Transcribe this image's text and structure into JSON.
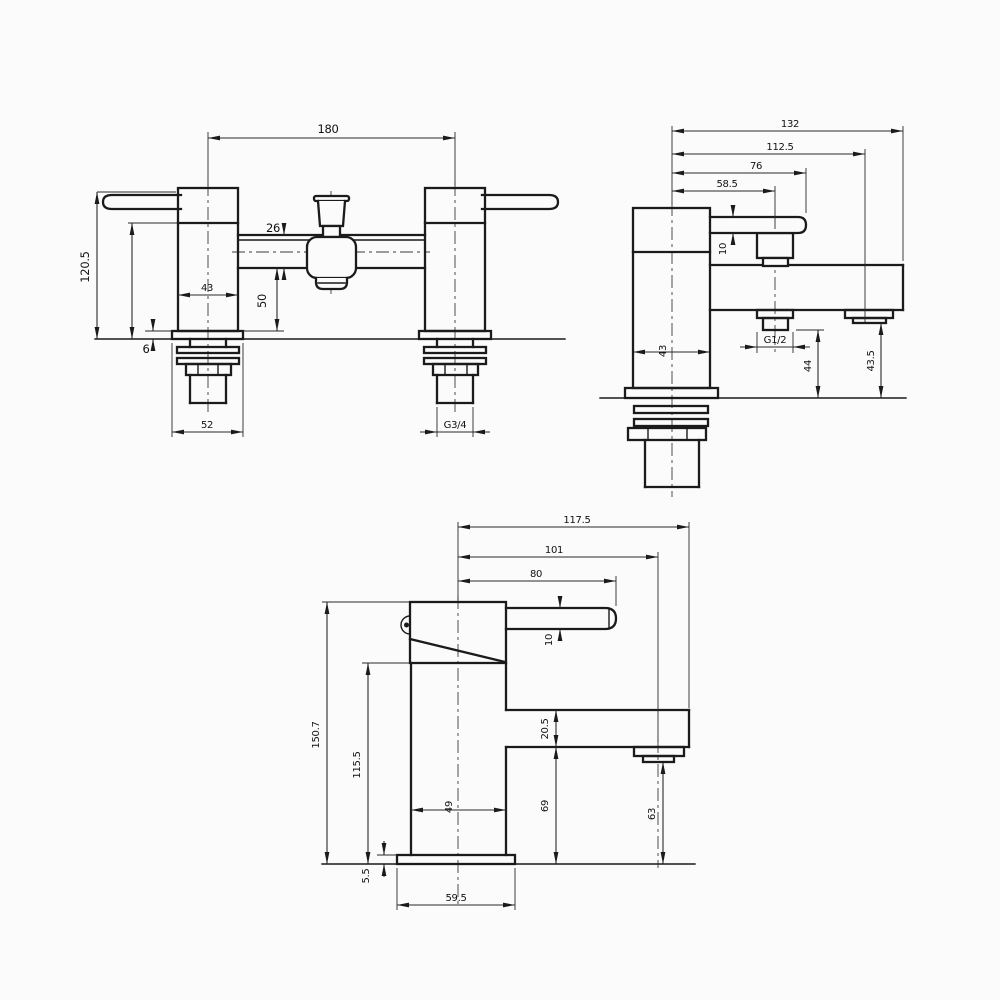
{
  "drawing": {
    "description": "tap-technical-dimension-drawing",
    "line_color": "#1b1b1b",
    "background": "#fbfbfb"
  },
  "views": {
    "front": {
      "name": "bath-shower-mixer-front-view",
      "dims": {
        "center_distance": "180",
        "total_height": "120.5",
        "spout_depth": "26",
        "spout_to_deck": "50",
        "body_width": "43",
        "flange_thickness": "6",
        "flange_width": "52",
        "inlet_thread": "G3/4"
      }
    },
    "side": {
      "name": "bath-shower-mixer-side-view",
      "dims": {
        "total_projection": "132",
        "spout_projection": "112.5",
        "handle_projection": "76",
        "shower_outlet_projection": "58.5",
        "handle_thickness": "10",
        "body_width": "43",
        "shower_thread": "G1/2",
        "shower_outlet_to_deck": "44",
        "spout_outlet_to_deck": "43.5"
      }
    },
    "basin": {
      "name": "basin-mixer-side-view",
      "dims": {
        "total_projection": "117.5",
        "spout_projection": "101",
        "handle_projection": "80",
        "handle_thickness": "10",
        "total_height": "150.7",
        "body_height": "115.5",
        "body_width": "49",
        "spout_depth": "20.5",
        "spout_underside_to_deck": "69",
        "outlet_to_deck": "63",
        "flange_thickness": "5.5",
        "flange_width": "59.5"
      }
    }
  }
}
